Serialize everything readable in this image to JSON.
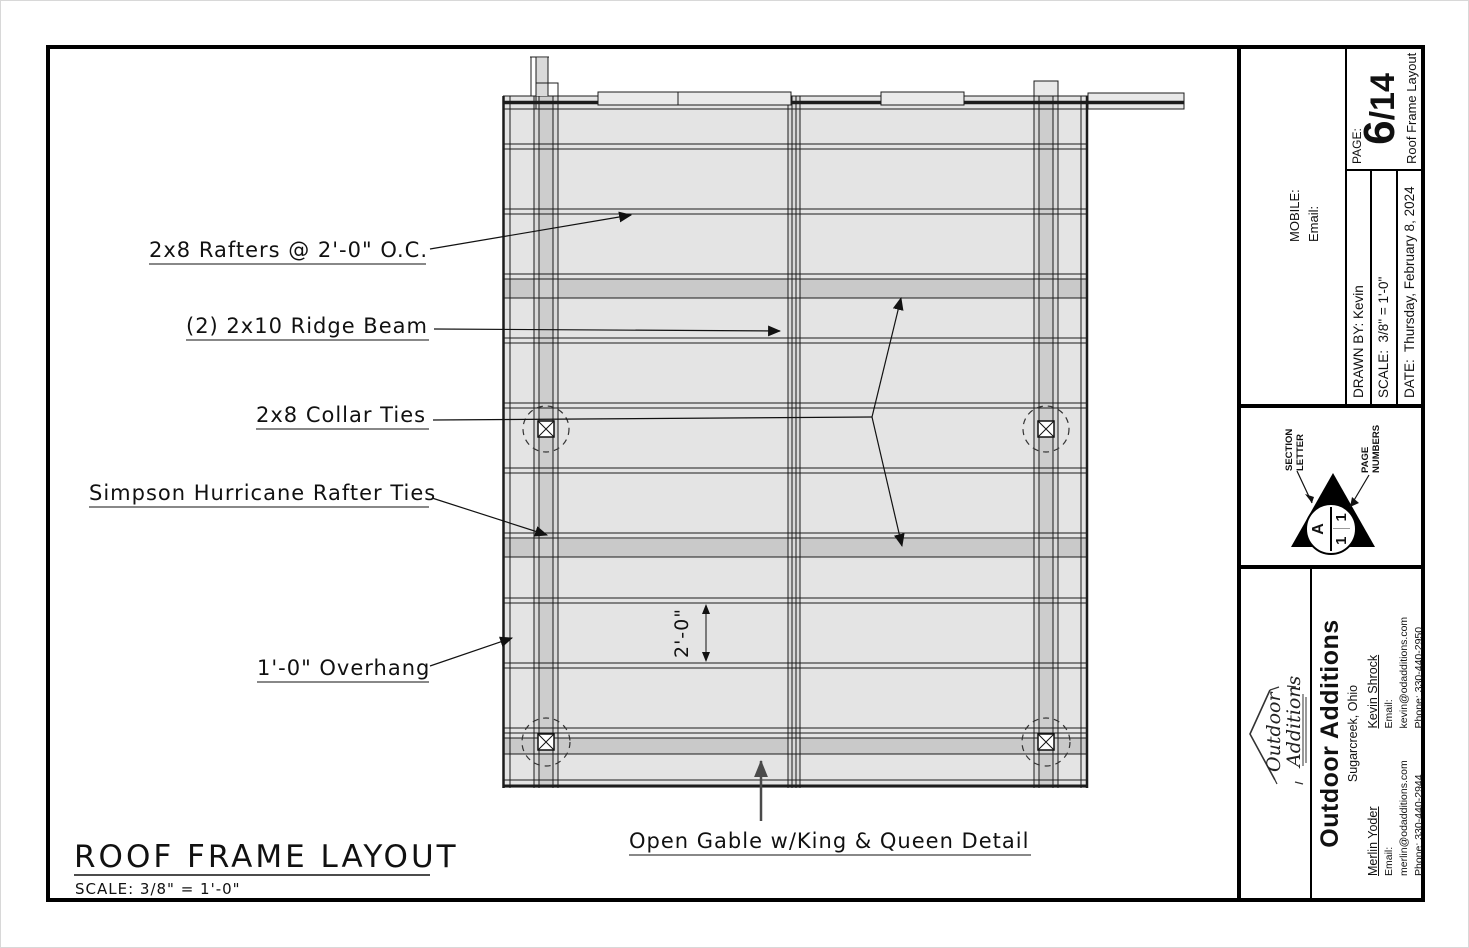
{
  "drawing": {
    "labels": {
      "rafters": "2x8 Rafters @ 2'-0\" O.C.",
      "ridge": "(2) 2x10 Ridge Beam",
      "collar": "2x8 Collar Ties",
      "hurricane": "Simpson Hurricane Rafter Ties",
      "overhang": "1'-0\" Overhang",
      "open_gable": "Open Gable w/King & Queen Detail",
      "dimension": "2'-0\""
    },
    "title": "ROOF FRAME LAYOUT",
    "scale_note": "SCALE: 3/8\" = 1'-0\""
  },
  "titleblock": {
    "contact_header": {
      "mobile_label": "MOBILE:",
      "email_label": "Email:"
    },
    "meta": {
      "drawn_by": "DRAWN BY: Kevin",
      "scale": "SCALE:  3/8\" = 1'-0\"",
      "date": "DATE:  Thursday, February 8, 2024"
    },
    "page": {
      "label": "PAGE:",
      "number": "6",
      "total": "/14",
      "sheet_title": "Roof Frame Layout"
    },
    "section_key": {
      "letter_label": "SECTION LETTER",
      "numbers_label": "PAGE NUMBERS",
      "letter": "A",
      "num_left": "1",
      "num_right": "1"
    },
    "company": {
      "name": "Outdoor Additions",
      "city": "Sugarcreek, Ohio",
      "logo_line1": "Outdoor",
      "logo_line2": "Additions",
      "contacts": [
        {
          "name": "Merlin Yoder",
          "email": "Email: merlin@odadditions.com",
          "phone": "Phone: 330-440-2944"
        },
        {
          "name": "Kevin Shrock",
          "email": "Email: kevin@odadditions.com",
          "phone": "Phone: 330-440-2950"
        }
      ]
    }
  },
  "colors": {
    "line": "#1c1c1c",
    "roof_fill": "#e4e4e4",
    "collar_band_fill": "#c9c9c9",
    "post_column_fill": "#cdcdcd"
  }
}
